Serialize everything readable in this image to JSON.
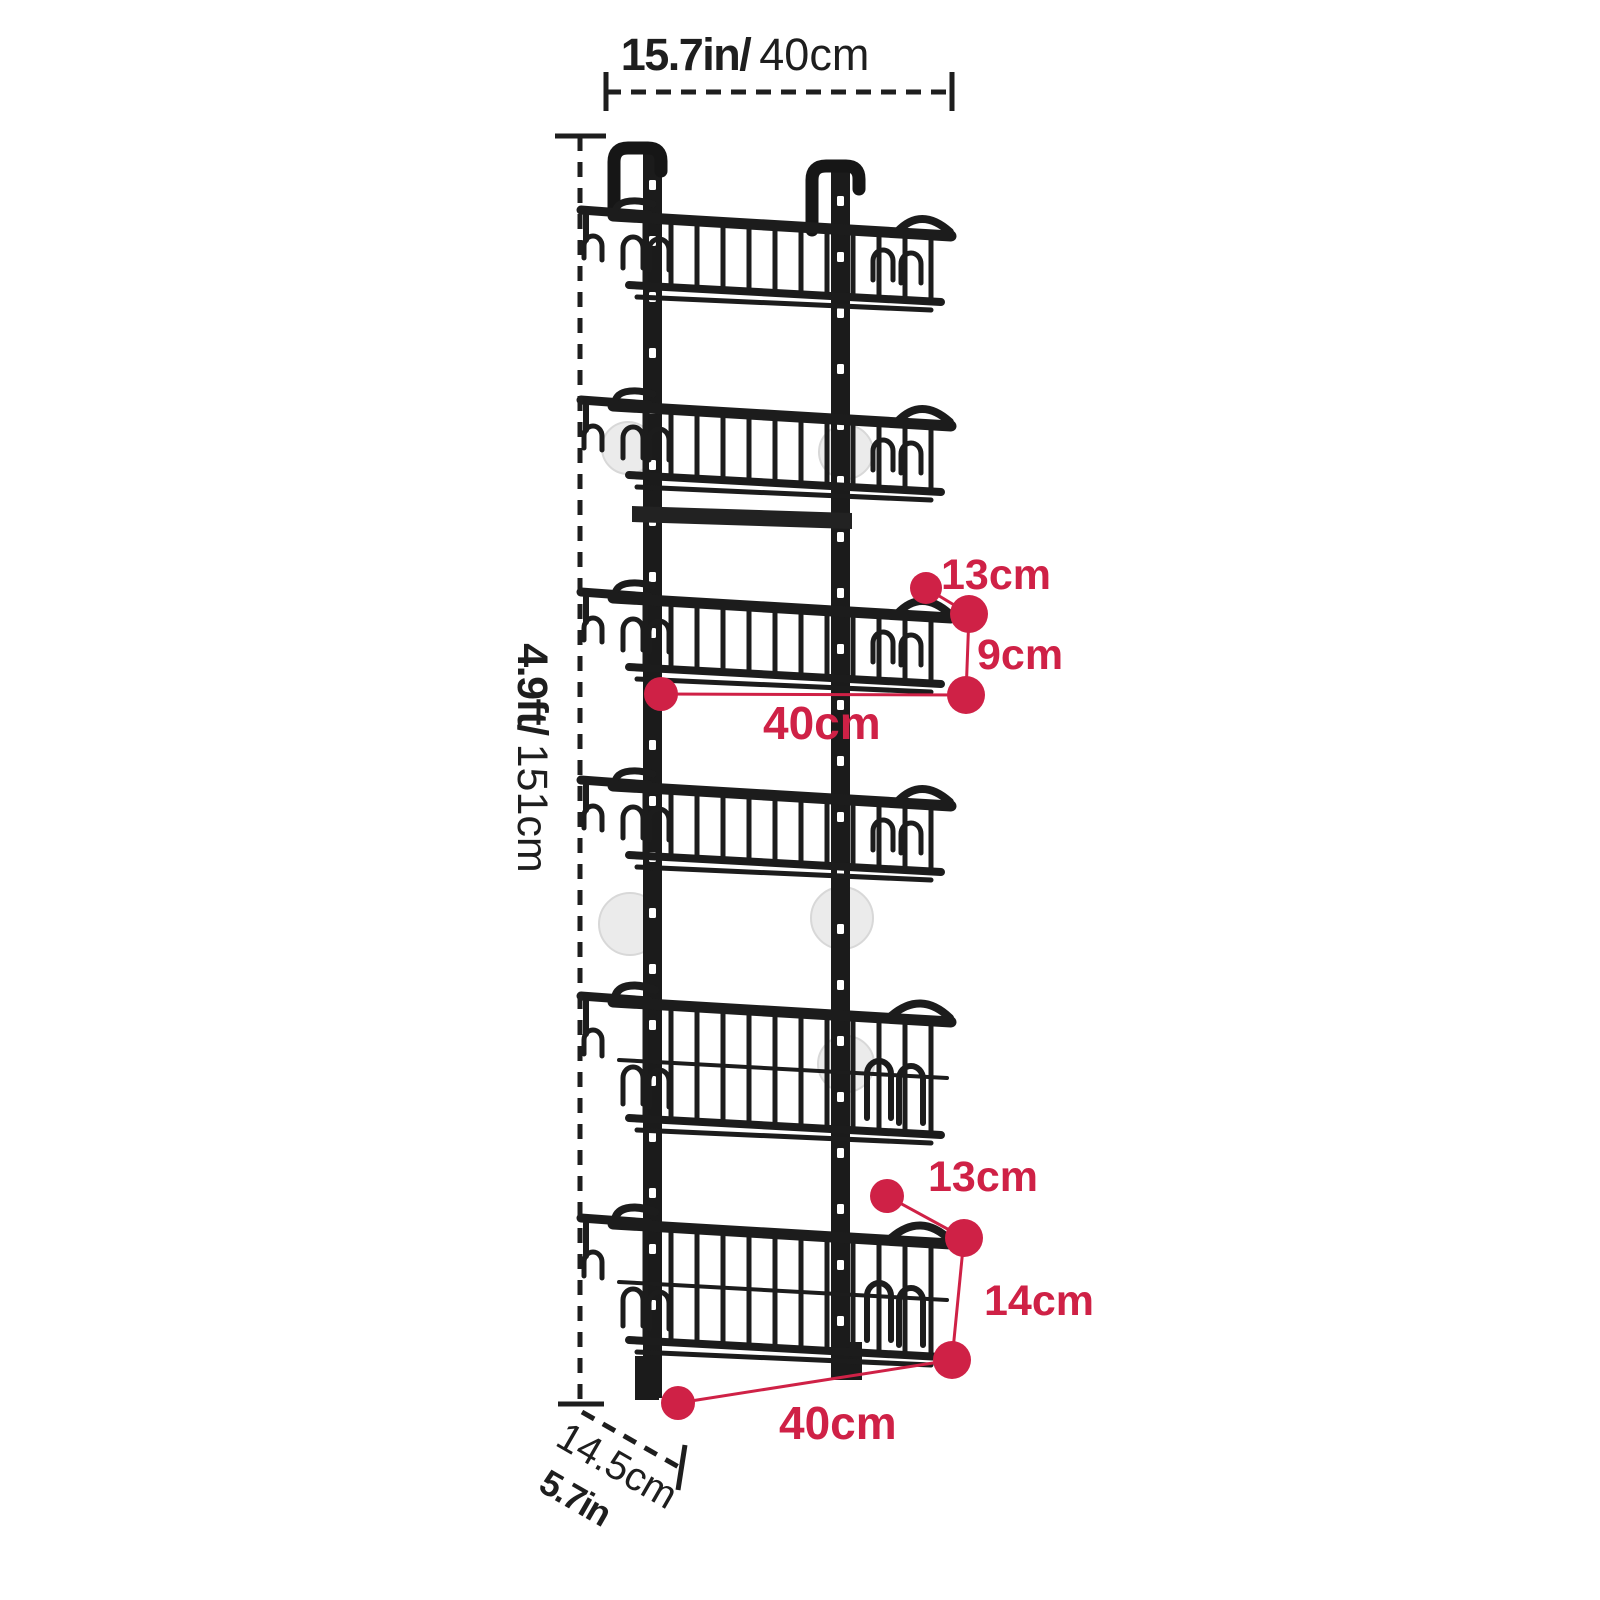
{
  "labels": {
    "top_width": {
      "imperial": "15.7in/",
      "metric": "40cm"
    },
    "total_height": {
      "imperial": "4.9ft/",
      "metric": "151cm"
    },
    "middle_basket": {
      "depth": "13cm",
      "height": "9cm",
      "width": "40cm"
    },
    "bottom_basket": {
      "depth": "13cm",
      "height": "14cm",
      "width": "40cm"
    },
    "base_depth": {
      "metric": "14.5cm",
      "imperial": "5.7in"
    }
  },
  "colors": {
    "annotation_red": "#cf2146",
    "ink_black": "#1e1e1e",
    "rack_black": "#1c1c1c",
    "suction_cup_gray": "#ebebeb"
  }
}
